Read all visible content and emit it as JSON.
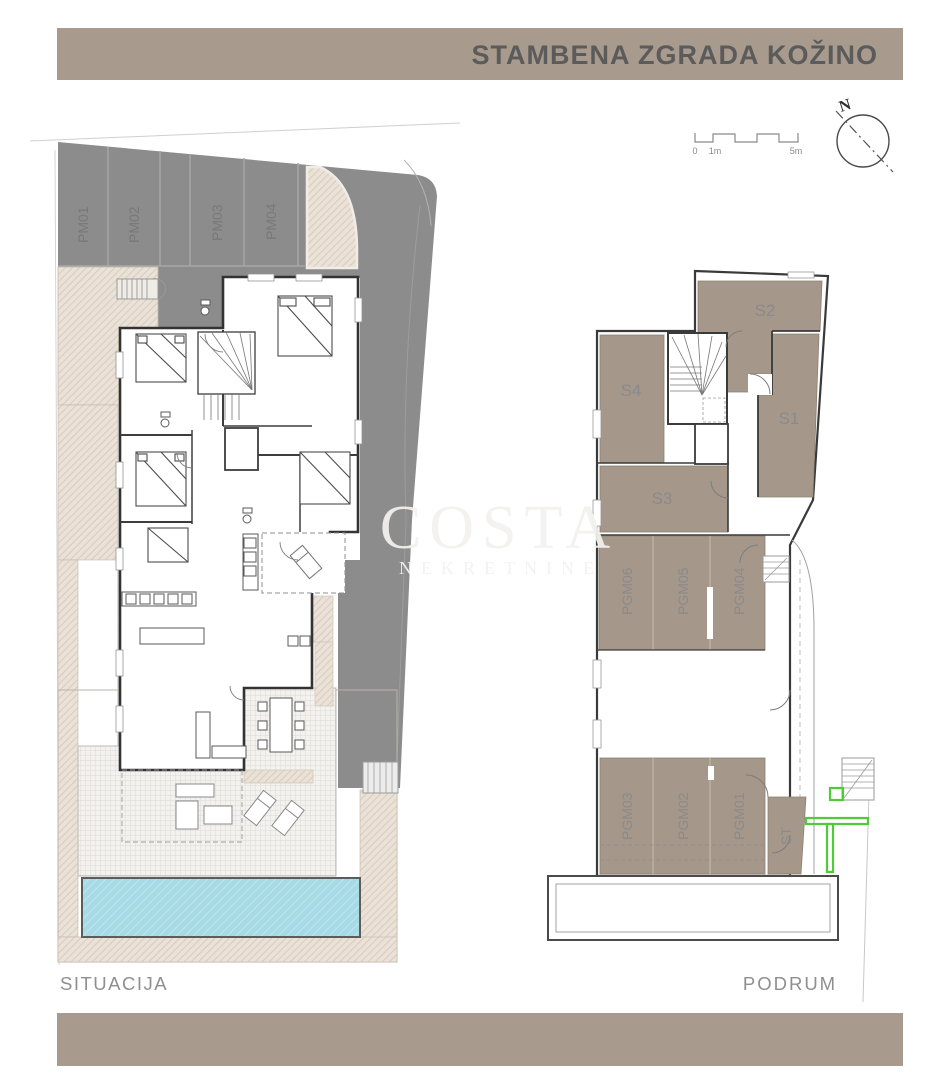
{
  "header": {
    "title": "STAMBENA ZGRADA KOŽINO"
  },
  "watermark": {
    "line1": "COSTA",
    "line2": "NEKRETNINE"
  },
  "compass": {
    "label": "N"
  },
  "scale_bar": {
    "labels": [
      "0",
      "1m",
      "5m"
    ]
  },
  "site_plan": {
    "caption": "SITUACIJA",
    "parking_labels": [
      "PM01",
      "PM02",
      "PM03",
      "PM04"
    ]
  },
  "basement_plan": {
    "caption": "PODRUM",
    "storage_labels": [
      "S2",
      "S4",
      "S1",
      "S3"
    ],
    "garage_labels_top": [
      "PGM06",
      "PGM05",
      "PGM04"
    ],
    "garage_labels_bottom": [
      "PGM03",
      "PGM02",
      "PGM01"
    ],
    "stairwell_label": "ST"
  },
  "colors": {
    "bar": "#a89b8d",
    "road": "#8c8c8c",
    "room_fill": "#a5988a",
    "pool": "#a6dbe5",
    "accent_green": "#4ecb36"
  }
}
